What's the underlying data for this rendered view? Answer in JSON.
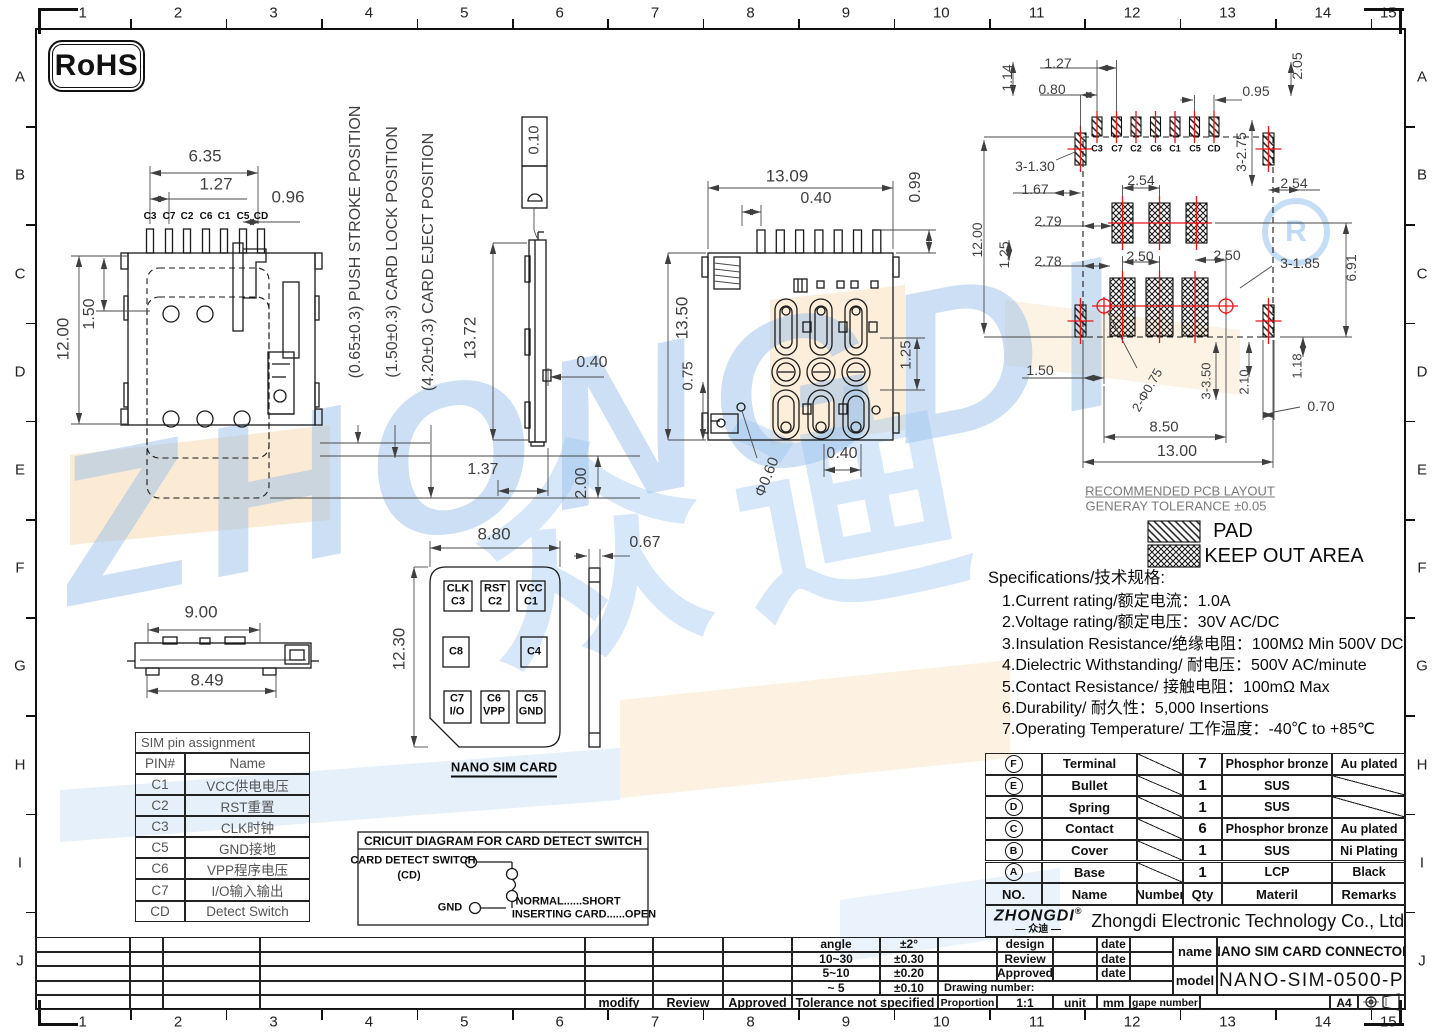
{
  "sheet": {
    "zone_numbers": [
      "1",
      "2",
      "3",
      "4",
      "5",
      "6",
      "7",
      "8",
      "9",
      "10",
      "11",
      "12",
      "13",
      "14",
      "15"
    ],
    "zone_letters": [
      "A",
      "B",
      "C",
      "D",
      "E",
      "F",
      "G",
      "H",
      "I",
      "J"
    ],
    "rohs": "RoHS"
  },
  "watermark": {
    "word": "ZHONGDI",
    "cn": "众迪",
    "reg": "R"
  },
  "legend": {
    "pad": "PAD",
    "keep_out": "KEEP OUT AREA",
    "title1": "RECOMMENDED PCB LAYOUT",
    "title2": "GENERAY TOLERANCE ±0.05"
  },
  "specs": {
    "title": "Specifications/技术规格:",
    "items": [
      "1.Current rating/额定电流：1.0A",
      "2.Voltage rating/额定电压：30V AC/DC",
      "3.Insulation Resistance/绝缘电阻：100MΩ Min 500V DC",
      "4.Dielectric Withstanding/ 耐电压：500V AC/minute",
      "5.Contact Resistance/ 接触电阻：100mΩ  Max",
      "6.Durability/ 耐久性：5,000 Insertions",
      "7.Operating Temperature/ 工作温度：-40℃  to +85℃"
    ]
  },
  "sim_pin_table": {
    "title": "SIM pin assignment",
    "rows": [
      [
        "PIN#",
        "Name"
      ],
      [
        "C1",
        "VCC供电电压"
      ],
      [
        "C2",
        "RST重置"
      ],
      [
        "C3",
        "CLK时钟"
      ],
      [
        "C5",
        "GND接地"
      ],
      [
        "C6",
        "VPP程序电压"
      ],
      [
        "C7",
        "I/O输入输出"
      ],
      [
        "CD",
        "Detect Switch"
      ]
    ]
  },
  "parts_table": {
    "headers": [
      "NO.",
      "Name",
      "Number",
      "Qty",
      "Materil",
      "Remarks"
    ],
    "rows": [
      [
        "F",
        "Terminal",
        "7",
        "Phosphor bronze",
        "Au plated"
      ],
      [
        "E",
        "Bullet",
        "1",
        "SUS",
        ""
      ],
      [
        "D",
        "Spring",
        "1",
        "SUS",
        ""
      ],
      [
        "C",
        "Contact",
        "6",
        "Phosphor bronze",
        "Au plated"
      ],
      [
        "B",
        "Cover",
        "1",
        "SUS",
        "Ni Plating"
      ],
      [
        "A",
        "Base",
        "1",
        "LCP",
        "Black"
      ]
    ]
  },
  "company": {
    "logo": "ZHONGDI",
    "reg": "®",
    "logo_cn": "— 众迪 —",
    "name": "Zhongdi Electronic Technology Co., Ltd"
  },
  "title_block": {
    "design": "design",
    "review": "Review",
    "approved": "Approved",
    "date": "date",
    "drawing_number": "Drawing number:",
    "proportion_label": "Proportion",
    "proportion": "1:1",
    "unit_label": "unit",
    "unit": "mm",
    "gape_label": "gape number",
    "paper": "A4",
    "name_label": "name",
    "name": "NANO SIM CARD CONNECTOR",
    "model_label": "model",
    "model": "NANO-SIM-0500-P"
  },
  "tolerance_table": {
    "rows": [
      [
        "angle",
        "±2°"
      ],
      [
        "10~30",
        "±0.30"
      ],
      [
        "5~10",
        "±0.20"
      ],
      [
        "~ 5",
        "±0.10"
      ]
    ],
    "footer": "Tolerance not specified",
    "modify": "modify",
    "review": "Review",
    "approved": "Approved"
  },
  "labels": [
    [
      "6.35",
      205,
      156,
      0,
      17,
      "dim"
    ],
    [
      "1.27",
      216,
      184,
      0,
      17,
      "dim"
    ],
    [
      "0.96",
      288,
      197,
      0,
      17,
      "dim"
    ],
    [
      "C3",
      150,
      217,
      0,
      10,
      "pin"
    ],
    [
      "C7",
      169,
      217,
      0,
      10,
      "pin"
    ],
    [
      "C2",
      187,
      217,
      0,
      10,
      "pin"
    ],
    [
      "C6",
      206,
      217,
      0,
      10,
      "pin"
    ],
    [
      "C1",
      224,
      217,
      0,
      10,
      "pin"
    ],
    [
      "C5",
      243,
      217,
      0,
      10,
      "pin"
    ],
    [
      "CD",
      261,
      217,
      0,
      10,
      "pin"
    ],
    [
      "1.50",
      90,
      314,
      -90,
      16,
      "dim"
    ],
    [
      "12.00",
      63,
      339,
      -90,
      17,
      "dim"
    ],
    [
      "1.37",
      483,
      470,
      0,
      16,
      "dim"
    ],
    [
      "2.00",
      582,
      483,
      -90,
      16,
      "dim"
    ],
    [
      "(0.65±0.3) PUSH STROKE POSITION",
      356,
      242,
      -90,
      16,
      "dim"
    ],
    [
      "(1.50±0.3) CARD LOCK POSITION",
      393,
      252,
      -90,
      16,
      "dim"
    ],
    [
      "(4.20±0.3) CARD EJECT POSITION",
      429,
      262,
      -90,
      16,
      "dim"
    ],
    [
      "0.10",
      534,
      140,
      -90,
      15,
      "dim"
    ],
    [
      "13.72",
      470,
      338,
      -90,
      17,
      "dim"
    ],
    [
      "0.40",
      592,
      363,
      0,
      16,
      "dim"
    ],
    [
      "13.09",
      787,
      176,
      0,
      17,
      "dim"
    ],
    [
      "0.40",
      816,
      199,
      0,
      16,
      "dim"
    ],
    [
      "0.99",
      916,
      187,
      -90,
      16,
      "dim"
    ],
    [
      "13.50",
      682,
      318,
      -90,
      17,
      "dim"
    ],
    [
      "0.75",
      688,
      376,
      -90,
      15,
      "dim"
    ],
    [
      "1.25",
      906,
      355,
      -90,
      15,
      "dim"
    ],
    [
      "0.40",
      842,
      454,
      0,
      16,
      "dim"
    ],
    [
      "Φ0.60",
      767,
      477,
      -68,
      15,
      "dim"
    ],
    [
      "1.14",
      1007,
      78,
      -90,
      14,
      "dim"
    ],
    [
      "1.27",
      1058,
      63,
      0,
      14,
      "dim"
    ],
    [
      "0.80",
      1052,
      89,
      0,
      14,
      "dim"
    ],
    [
      "0.95",
      1256,
      91,
      0,
      14,
      "dim"
    ],
    [
      "2.05",
      1297,
      66,
      -90,
      14,
      "dim"
    ],
    [
      "3-2.75",
      1241,
      152,
      -90,
      14,
      "dim"
    ],
    [
      "C3",
      1097,
      149,
      0,
      9,
      "pin"
    ],
    [
      "C7",
      1117,
      149,
      0,
      9,
      "pin"
    ],
    [
      "C2",
      1136,
      149,
      0,
      9,
      "pin"
    ],
    [
      "C6",
      1156,
      149,
      0,
      9,
      "pin"
    ],
    [
      "C1",
      1175,
      149,
      0,
      9,
      "pin"
    ],
    [
      "C5",
      1195,
      149,
      0,
      9,
      "pin"
    ],
    [
      "CD",
      1214,
      149,
      0,
      9,
      "pin"
    ],
    [
      "3-1.30",
      1035,
      166,
      0,
      14,
      "dim"
    ],
    [
      "1.67",
      1035,
      189,
      0,
      14,
      "dim"
    ],
    [
      "2.54",
      1141,
      180,
      0,
      14,
      "dim"
    ],
    [
      "2.54",
      1294,
      183,
      0,
      14,
      "dim"
    ],
    [
      "12.00",
      977,
      240,
      -90,
      14,
      "dim"
    ],
    [
      "2.79",
      1048,
      221,
      0,
      14,
      "dim"
    ],
    [
      "1.25",
      1004,
      255,
      -90,
      14,
      "dim"
    ],
    [
      "2.78",
      1048,
      261,
      0,
      14,
      "dim"
    ],
    [
      "2.50",
      1140,
      256,
      0,
      14,
      "dim"
    ],
    [
      "2.50",
      1227,
      255,
      0,
      14,
      "dim"
    ],
    [
      "3-1.85",
      1300,
      263,
      0,
      14,
      "dim"
    ],
    [
      "6.91",
      1351,
      268,
      -90,
      14,
      "dim"
    ],
    [
      "1.50",
      1040,
      370,
      0,
      14,
      "dim"
    ],
    [
      "2-Φ0.75",
      1147,
      390,
      -60,
      13,
      "dim"
    ],
    [
      "3-3.50",
      1206,
      381,
      -90,
      13,
      "dim"
    ],
    [
      "2.10",
      1244,
      382,
      -90,
      13,
      "dim"
    ],
    [
      "1.18",
      1297,
      366,
      -90,
      13,
      "dim"
    ],
    [
      "0.70",
      1321,
      406,
      0,
      14,
      "dim"
    ],
    [
      "8.50",
      1164,
      427,
      0,
      15,
      "dim"
    ],
    [
      "13.00",
      1177,
      452,
      0,
      16,
      "dim"
    ],
    [
      "9.00",
      201,
      612,
      0,
      17,
      "dim"
    ],
    [
      "8.49",
      207,
      680,
      0,
      17,
      "dim"
    ],
    [
      "8.80",
      494,
      534,
      0,
      17,
      "dim"
    ],
    [
      "0.67",
      645,
      543,
      0,
      16,
      "dim"
    ],
    [
      "12.30",
      399,
      649,
      -90,
      17,
      "dim"
    ],
    [
      "RECOMMENDED PCB LAYOUT",
      1180,
      491,
      0,
      13,
      "gry ul"
    ],
    [
      "GENERAY TOLERANCE ±0.05",
      1176,
      506,
      0,
      13,
      "gry"
    ],
    [
      "PAD",
      1233,
      531,
      0,
      20,
      "blk"
    ],
    [
      "KEEP OUT AREA",
      1284,
      556,
      0,
      20,
      "blk"
    ],
    [
      "NANO SIM CARD",
      504,
      769,
      0,
      13,
      "blk bold ul2"
    ],
    [
      "CRICUIT DIAGRAM FOR CARD DETECT SWITCH",
      503,
      841,
      0,
      12,
      "blk bold"
    ],
    [
      "CARD DETECT SWITCH",
      413,
      861,
      0,
      11,
      "blk bold"
    ],
    [
      "(CD)",
      409,
      876,
      0,
      11,
      "blk bold"
    ],
    [
      "GND",
      450,
      908,
      0,
      11,
      "blk bold"
    ],
    [
      "NORMAL......SHORT",
      568,
      902,
      0,
      11,
      "blk bold"
    ],
    [
      "INSERTING CARD......OPEN",
      584,
      915,
      0,
      11,
      "blk bold"
    ],
    [
      "CLK",
      458,
      589,
      0,
      11,
      "blk bold"
    ],
    [
      "C3",
      458,
      602,
      0,
      11,
      "blk bold"
    ],
    [
      "RST",
      495,
      589,
      0,
      11,
      "blk bold"
    ],
    [
      "C2",
      495,
      602,
      0,
      11,
      "blk bold"
    ],
    [
      "VCC",
      531,
      589,
      0,
      11,
      "blk bold"
    ],
    [
      "C1",
      531,
      602,
      0,
      11,
      "blk bold"
    ],
    [
      "C8",
      456,
      652,
      0,
      11,
      "blk bold"
    ],
    [
      "C4",
      534,
      652,
      0,
      11,
      "blk bold"
    ],
    [
      "C7",
      457,
      699,
      0,
      11,
      "blk bold"
    ],
    [
      "I/O",
      457,
      712,
      0,
      11,
      "blk bold"
    ],
    [
      "C6",
      494,
      699,
      0,
      11,
      "blk bold"
    ],
    [
      "VPP",
      494,
      712,
      0,
      11,
      "blk bold"
    ],
    [
      "C5",
      531,
      699,
      0,
      11,
      "blk bold"
    ],
    [
      "GND",
      531,
      712,
      0,
      11,
      "blk bold"
    ]
  ]
}
